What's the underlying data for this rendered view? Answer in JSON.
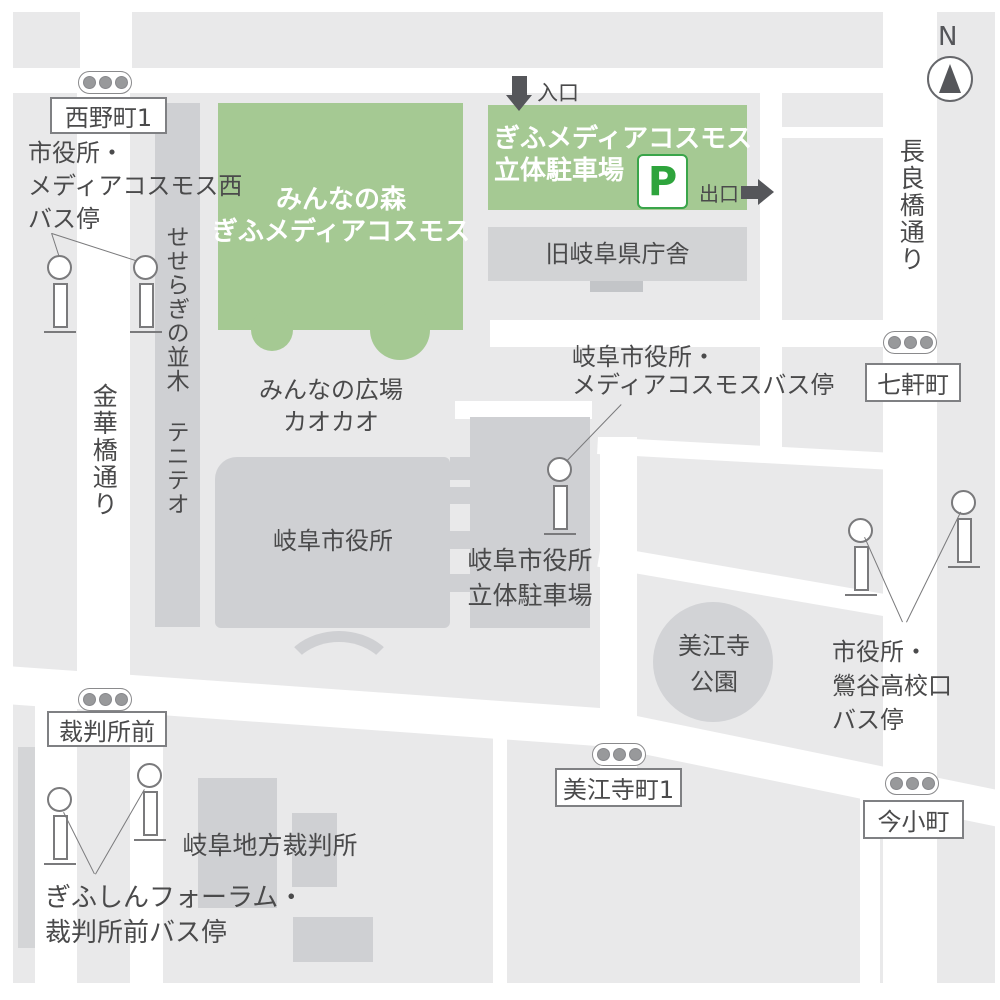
{
  "map": {
    "compass_label": "N",
    "streets": {
      "nagarabashi": "長良橋通り",
      "kinkabashi": "金華橋通り",
      "seseragi": "せせらぎの並木 テニテオ"
    },
    "intersections": {
      "nishinomachi1": "西野町1",
      "shichikencho": "七軒町",
      "saibanshomae": "裁判所前",
      "miejicho1": "美江寺町1",
      "imakomachi": "今小町"
    },
    "places": {
      "minna_no_mori": {
        "line1": "みんなの森",
        "line2": "ぎふメディアコスモス"
      },
      "media_cosmos_parking": {
        "line1": "ぎふメディアコスモス",
        "line2": "立体駐車場",
        "p_mark": "P"
      },
      "old_prefectural_office": "旧岐阜県庁舎",
      "minna_no_hiroba": {
        "line1": "みんなの広場",
        "line2": "カオカオ"
      },
      "city_hall": "岐阜市役所",
      "city_hall_parking": {
        "line1": "岐阜市役所",
        "line2": "立体駐車場"
      },
      "mieji_park": {
        "line1": "美江寺",
        "line2": "公園"
      },
      "district_court": "岐阜地方裁判所"
    },
    "gates": {
      "entrance": "入口",
      "exit": "出口"
    },
    "bus_stops": {
      "west": [
        "市役所・",
        "メディアコスモス西",
        "バス停"
      ],
      "media_cosmos": [
        "岐阜市役所・",
        "メディアコスモスバス停"
      ],
      "uguisudani": [
        "市役所・",
        "鶯谷高校口",
        "バス停"
      ],
      "forum": [
        "ぎふしんフォーラム・",
        "裁判所前バス停"
      ]
    },
    "colors": {
      "building_green": "#a5c993",
      "p_green": "#2ea43c",
      "block_gray": "#e9e9ea",
      "building_gray": "#cfd0d3",
      "road_white": "#ffffff",
      "text_gray": "#4a4a4b"
    }
  }
}
